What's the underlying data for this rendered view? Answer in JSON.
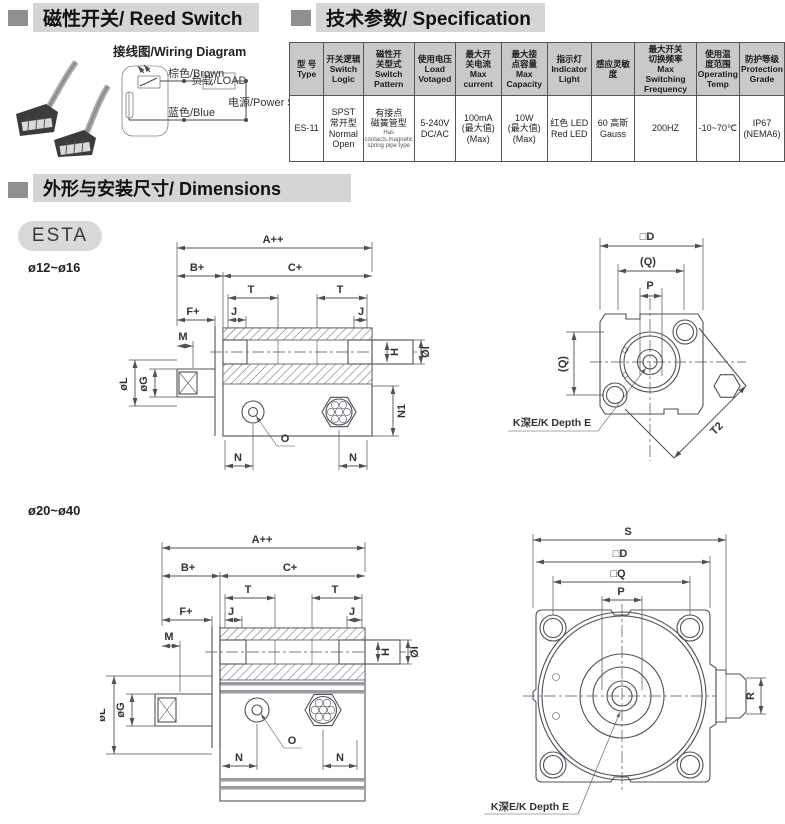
{
  "headers": {
    "reed_switch": "磁性开关/ Reed Switch",
    "specification": "技术参数/ Specification",
    "dimensions": "外形与安装尺寸/ Dimensions"
  },
  "wiring": {
    "title": "接线图/Wiring Diagram",
    "brown": "棕色/Brown",
    "load": "负载/LOAD",
    "power": "电源/Power Supply",
    "blue": "蓝色/Blue"
  },
  "spec_table": {
    "headers": [
      "型 号\nType",
      "开关逻辑\nSwitch\nLogic",
      "磁性开\n关型式\nSwitch\nPattern",
      "使用电压\nLoad\nVotaged",
      "最大开\n关电流\nMax\ncurrent",
      "最大接\n点容量\nMax\nCapacity",
      "指示灯\nIndicator\nLight",
      "感应灵敏度",
      "最大开关\n切换频率\nMax Switching\nFrequency",
      "使用温\n度范围\nOperating\nTemp",
      "防护等级\nProtection\nGrade"
    ],
    "row": [
      "ES-11",
      "SPST\n常开型\nNormal\nOpen",
      "有接点\n磁簧管型",
      "5-240V\nDC/AC",
      "100mA\n(最大值)\n(Max)",
      "10W\n(最大值)\n(Max)",
      "红色 LED\nRed LED",
      "60 高斯\nGauss",
      "200HZ",
      "-10~70℃",
      "IP67\n(NEMA6)"
    ],
    "row3_sub": "Has contacts,magnetic\nspring pipe type"
  },
  "dims": {
    "series": "ESTA",
    "model_small": "ø12~ø16",
    "model_large": "ø20~ø40"
  },
  "labels": {
    "a": "A++",
    "b": "B+",
    "c": "C+",
    "t": "T",
    "j": "J",
    "f": "F+",
    "m": "M",
    "h": "H",
    "oi": "ØI",
    "ol": "øL",
    "og": "øG",
    "n1": "N1",
    "n": "N",
    "o": "O",
    "sq_d": "□D",
    "q_paren": "(Q)",
    "p": "P",
    "t2": "T2",
    "k_depth": "K深E/K Depth E",
    "s": "S",
    "sq_q": "□Q",
    "r": "R"
  }
}
